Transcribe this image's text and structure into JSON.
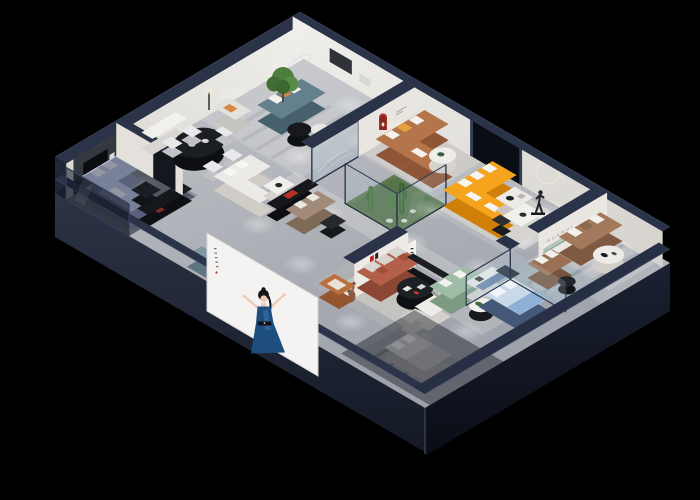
{
  "scene": {
    "type": "3d-isometric-showroom-cutaway-render",
    "background": "#000000",
    "description": "Night-time cutaway 3D floor plan of a furniture brand showroom with spotlit room vignettes"
  },
  "brand": {
    "logo_characters": "华辉",
    "wall_letters": "HUAHUI",
    "logo_red": "#c0271f",
    "logo_dark": "#1e1e23"
  },
  "palette": {
    "shell_navy": "#2b3348",
    "floor_gray": "#b6b9be",
    "wall_white": "#e9e6e1",
    "arch_red": "#a5302a",
    "orange_sofa": "#f6a31e",
    "caramel_sofa": "#b4754a",
    "teal_sofa": "#64808f",
    "periwinkle_sofa": "#b7c3e2",
    "rust_sofa": "#b2604a",
    "sage_sofa": "#9fbda6",
    "tan_sofa": "#a3795c",
    "brown_loveseat": "#9b7054",
    "bed_blue": "#c9d9ea",
    "atrium_green": "#5d7a50",
    "poster_dress": "#1d4e7e"
  },
  "signage": {
    "huahui_letter_color": "#9a9a96",
    "shelf_green": "#b7c6b9"
  }
}
